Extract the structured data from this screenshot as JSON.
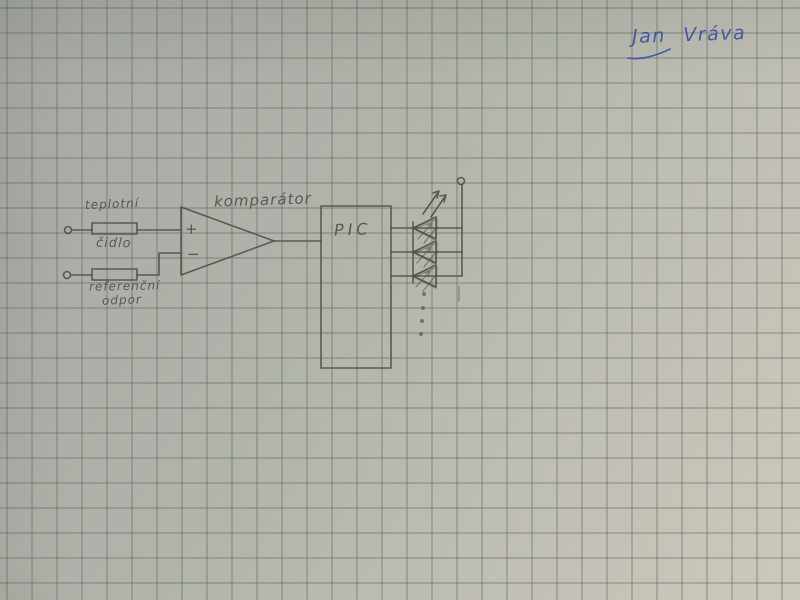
{
  "colors": {
    "paper_dark": "#a5a9a2",
    "paper_mid": "#b2b5ac",
    "paper_light": "#ccc8bd",
    "grid_line": "#8f948b",
    "pencil": "#4d4d47",
    "ink": "#3f50a3"
  },
  "signature": {
    "text": "Jan Vráva"
  },
  "diagram": {
    "labels": {
      "sensor_line1": "teplotní",
      "sensor_line2": "čidlo",
      "reference_line1": "referenční",
      "reference_line2": "odpor",
      "comparator": "komparátor",
      "plus": "+",
      "minus": "−",
      "mcu": "PIC"
    },
    "structure": {
      "type": "hand-drawn circuit schematic on squared paper",
      "blocks": [
        "input terminal → resistor 'teplotní čidlo' → comparator + input",
        "input terminal → resistor 'referenční odpor' → comparator − input",
        "komparátor output → PIC",
        "PIC drives 3 drawn LEDs with light-emission arrows",
        "LEDs share common line to top supply terminal",
        "4 vertical dots indicate more LEDs"
      ],
      "led_count_drawn": 3,
      "continuation_dots": 4
    }
  }
}
